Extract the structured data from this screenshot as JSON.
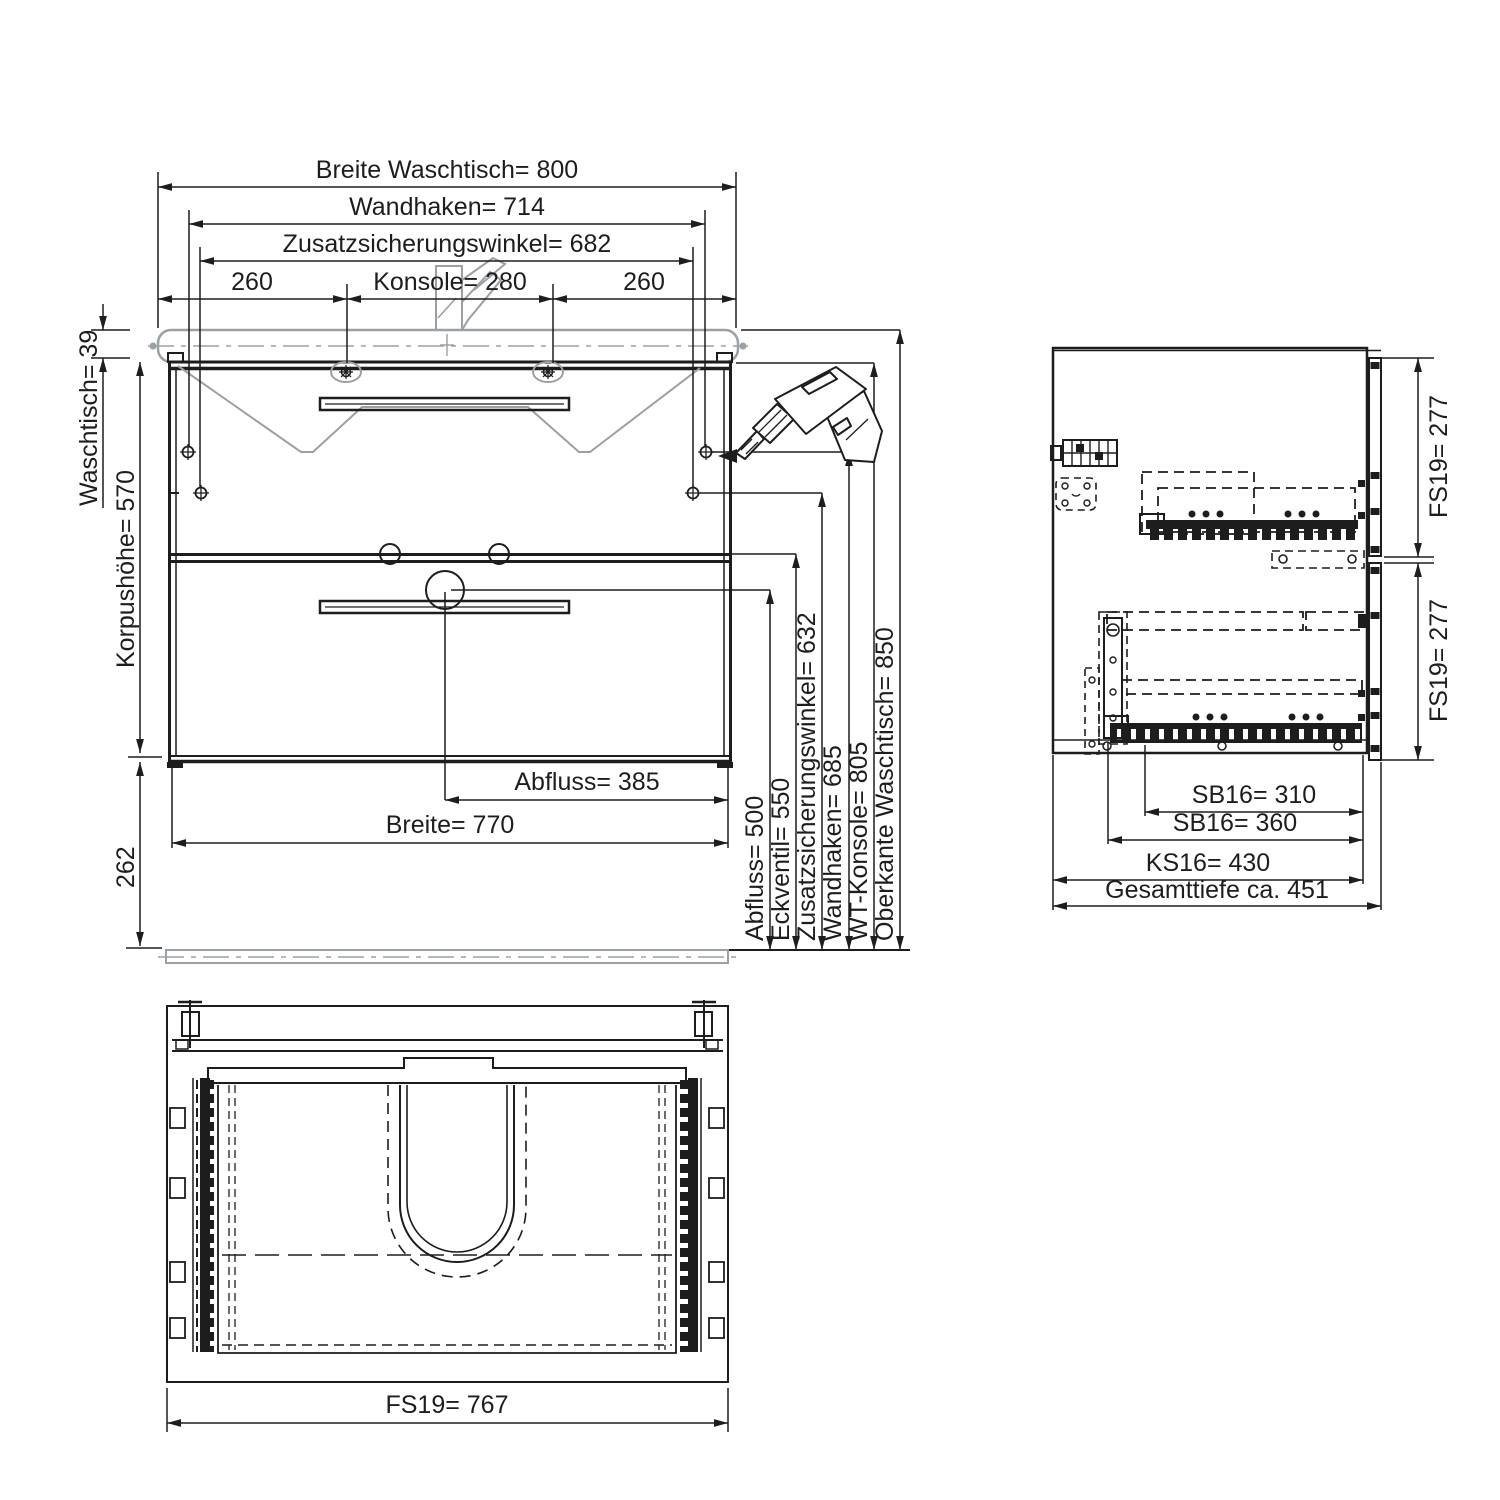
{
  "drawing": {
    "type": "technical-drawing-bathroom-vanity",
    "colors": {
      "line": "#1d1d1d",
      "light_outline": "#9aa0a4",
      "background": "#ffffff"
    },
    "front_view": {
      "top_dims": {
        "breite_waschtisch": "Breite Waschtisch= 800",
        "wandhaken": "Wandhaken=  714",
        "zusatzsicherungswinkel": "Zusatzsicherungswinkel=  682",
        "left_260": "260",
        "konsole": "Konsole= 280",
        "right_260": "260"
      },
      "left_dims": {
        "waschtisch": "Waschtisch= 39",
        "korpushoehe": "Korpushöhe=  570",
        "sockel": "262"
      },
      "bottom_dims": {
        "abfluss": "Abfluss= 385",
        "breite": "Breite= 770"
      },
      "right_dims": [
        "Abfluss= 500",
        "Eckventil= 550",
        "Zusatzsicherungswinkel= 632",
        "Wandhaken= 685",
        "WT-Konsole= 805",
        "Oberkante Waschtisch= 850"
      ]
    },
    "side_view": {
      "fs19_top": "FS19=  277",
      "fs19_bottom": "FS19=  277",
      "sb16_310": "SB16= 310",
      "sb16_360": "SB16= 360",
      "ks16": "KS16=  430",
      "gesamttiefe": "Gesamttiefe ca. 451"
    },
    "top_view": {
      "fs19": "FS19= 767"
    }
  }
}
